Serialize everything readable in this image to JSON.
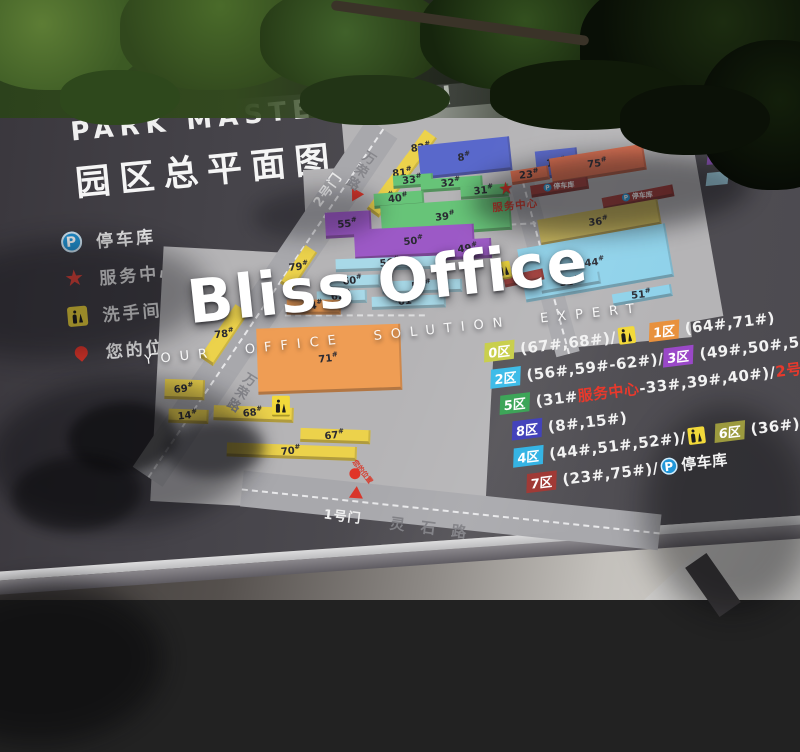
{
  "title": {
    "en": "PARK MASTER PLAN",
    "zh": "园区总平面图"
  },
  "watermark": {
    "brand": "Bliss Office",
    "tagline": "YOUR OFFICE SOLUTION EXPERT"
  },
  "map_legend": {
    "items": [
      {
        "icon": "parking-icon",
        "label": "停车库"
      },
      {
        "icon": "service-center-icon",
        "label": "服务中心"
      },
      {
        "icon": "restroom-icon",
        "label": "洗手间"
      },
      {
        "icon": "your-location-icon",
        "label": "您的位置"
      }
    ]
  },
  "zone_legend": {
    "rows": [
      {
        "left_zone": "0区",
        "left_name": "缤纷尚街",
        "swatch": "#e8cf45",
        "right_zone": "5区",
        "right_name": "视听影视"
      },
      {
        "left_zone": "1区",
        "left_name": "VR电竞娱乐",
        "swatch": "#e89440",
        "right_zone": "6区",
        "right_name": "筑梦飞船"
      },
      {
        "left_zone": "2区",
        "left_name": "创意聚落",
        "swatch": "#a6d7e8",
        "right_zone": "7区",
        "right_name": "创客空间"
      },
      {
        "left_zone": "3区",
        "left_name": "影视教育",
        "swatch": "#9659c2",
        "right_zone": "8区",
        "right_name": "数字传媒"
      },
      {
        "left_zone": "4区",
        "left_name": "模型工坊",
        "swatch": "#a6d7e8",
        "right_zone": "",
        "right_name": ""
      }
    ]
  },
  "building_index": {
    "rows": [
      [
        {
          "sw": "0区",
          "c": "#c9cf4d"
        },
        {
          "t": "(67#,68#)/"
        },
        {
          "wc": true
        },
        {
          "gap": 14
        },
        {
          "sw": "1区",
          "c": "#e8913d"
        },
        {
          "t": "(64#,71#)"
        }
      ],
      [
        {
          "sw": "2区",
          "c": "#3fbce8"
        },
        {
          "t": "(56#,59#-62#)/"
        },
        {
          "sw": "3区",
          "c": "#9a48c8"
        },
        {
          "t": "(49#,50#,55#)"
        }
      ],
      [
        {
          "sw": "5区",
          "c": "#3da558"
        },
        {
          "t": "(31#"
        },
        {
          "t": "服务中心",
          "red": true
        },
        {
          "t": "-33#,39#,40#)/"
        },
        {
          "t": "2号门",
          "red": true
        }
      ],
      [
        {
          "sw": "8区",
          "c": "#4343bb"
        },
        {
          "t": "(8#,15#)"
        }
      ],
      [
        {
          "sw": "4区",
          "c": "#35b4e4"
        },
        {
          "t": "(44#,51#,52#)/"
        },
        {
          "wc": true
        },
        {
          "gap": 10
        },
        {
          "sw": "6区",
          "c": "#9c9a3e"
        },
        {
          "t": "(36#)"
        }
      ],
      [
        {
          "sw": "7区",
          "c": "#a03a36"
        },
        {
          "t": "(23#,75#)/"
        },
        {
          "p": true
        },
        {
          "t": "停车库"
        }
      ]
    ]
  },
  "map": {
    "roads": {
      "wanrong": "万荣路",
      "lingshi": "灵石路"
    },
    "gates": {
      "gate2": "2号门",
      "gate1": "1号门"
    },
    "service_center": "服务中心",
    "parking_label": "停车库",
    "your_location": "您的位置",
    "colors": {
      "y": "#ecd24b",
      "o": "#ef9d54",
      "b": "#5968cb",
      "g": "#67c478",
      "p": "#9c59c6",
      "c": "#a8d9e8",
      "c2": "#8fd2ea",
      "ol": "#c4b257",
      "r": "#e2704f",
      "dr": "#a33e3a"
    },
    "buildings": [
      {
        "l": "82",
        "c": "y",
        "x": 295,
        "y": 27,
        "w": 15,
        "h": 36,
        "r": 42
      },
      {
        "l": "81",
        "c": "y",
        "x": 274,
        "y": 50,
        "w": 15,
        "h": 36,
        "r": 42
      },
      {
        "l": "80",
        "c": "y",
        "x": 253,
        "y": 73,
        "w": 15,
        "h": 36,
        "r": 42
      },
      {
        "l": "79",
        "c": "y",
        "x": 162,
        "y": 128,
        "w": 14,
        "h": 46,
        "r": 40
      },
      {
        "l": "78",
        "c": "y",
        "x": 80,
        "y": 178,
        "w": 16,
        "h": 64,
        "r": 40
      },
      {
        "l": "8",
        "c": "b",
        "x": 300,
        "y": 42,
        "w": 92,
        "h": 34,
        "r": 0
      },
      {
        "l": "15",
        "c": "b",
        "x": 416,
        "y": 60,
        "w": 42,
        "h": 28,
        "r": 0
      },
      {
        "l": "33",
        "c": "g",
        "x": 272,
        "y": 70,
        "w": 40,
        "h": 13,
        "r": 2
      },
      {
        "l": "32",
        "c": "g",
        "x": 299,
        "y": 77,
        "w": 62,
        "h": 13,
        "r": 2
      },
      {
        "l": "31",
        "c": "g",
        "x": 338,
        "y": 88,
        "w": 48,
        "h": 13,
        "r": 2
      },
      {
        "l": "40",
        "c": "g",
        "x": 251,
        "y": 86,
        "w": 50,
        "h": 15,
        "r": 2
      },
      {
        "l": "39",
        "c": "g",
        "x": 256,
        "y": 100,
        "w": 130,
        "h": 33,
        "r": 2
      },
      {
        "l": "55",
        "c": "p",
        "x": 200,
        "y": 100,
        "w": 46,
        "h": 26,
        "r": 3
      },
      {
        "l": "50",
        "c": "p",
        "x": 227,
        "y": 122,
        "w": 120,
        "h": 30,
        "r": 3
      },
      {
        "l": "49",
        "c": "p",
        "x": 317,
        "y": 140,
        "w": 46,
        "h": 20,
        "r": 3
      },
      {
        "l": "56",
        "c": "c",
        "x": 206,
        "y": 150,
        "w": 110,
        "h": 13,
        "r": 4
      },
      {
        "l": "60",
        "c": "c",
        "x": 195,
        "y": 164,
        "w": 54,
        "h": 13,
        "r": 4
      },
      {
        "l": "62",
        "c": "c",
        "x": 184,
        "y": 178,
        "w": 50,
        "h": 13,
        "r": 4
      },
      {
        "l": "59",
        "c": "c",
        "x": 250,
        "y": 176,
        "w": 80,
        "h": 13,
        "r": 4
      },
      {
        "l": "61",
        "c": "c",
        "x": 238,
        "y": 190,
        "w": 74,
        "h": 13,
        "r": 4
      },
      {
        "l": "64",
        "c": "o",
        "x": 153,
        "y": 184,
        "w": 54,
        "h": 15,
        "r": 6
      },
      {
        "l": "71",
        "c": "o",
        "x": 118,
        "y": 212,
        "w": 144,
        "h": 66,
        "r": 4
      },
      {
        "l": "69",
        "c": "y",
        "x": 23,
        "y": 250,
        "w": 40,
        "h": 20,
        "r": 8
      },
      {
        "l": "14",
        "c": "y",
        "x": 24,
        "y": 280,
        "w": 40,
        "h": 14,
        "r": 8
      },
      {
        "l": "68",
        "c": "y",
        "x": 69,
        "y": 284,
        "w": 80,
        "h": 15,
        "r": 8
      },
      {
        "l": "67",
        "c": "y",
        "x": 153,
        "y": 315,
        "w": 70,
        "h": 14,
        "r": 8
      },
      {
        "l": "70",
        "c": "y",
        "x": 78,
        "y": 326,
        "w": 130,
        "h": 14,
        "r": 8
      },
      {
        "l": "75",
        "c": "r",
        "x": 430,
        "y": 66,
        "w": 95,
        "h": 26,
        "r": -3
      },
      {
        "l": "23",
        "c": "r",
        "x": 390,
        "y": 76,
        "w": 38,
        "h": 14,
        "r": -3
      },
      {
        "type": "parking",
        "c": "dr",
        "x": 408,
        "y": 92,
        "w": 58,
        "h": 12,
        "r": -3
      },
      {
        "type": "parking",
        "c": "dr",
        "x": 478,
        "y": 110,
        "w": 72,
        "h": 12,
        "r": -5
      },
      {
        "l": "36",
        "c": "ol",
        "x": 412,
        "y": 124,
        "w": 122,
        "h": 26,
        "r": -4
      },
      {
        "l": "44",
        "c": "c2",
        "x": 390,
        "y": 150,
        "w": 150,
        "h": 54,
        "r": -4
      },
      {
        "l": "52",
        "c": "c2",
        "x": 408,
        "y": 188,
        "w": 60,
        "h": 12,
        "r": -4
      },
      {
        "l": "51",
        "c": "c2",
        "x": 478,
        "y": 208,
        "w": 60,
        "h": 12,
        "r": -4
      },
      {
        "c": "dr",
        "x": 372,
        "y": 179,
        "w": 40,
        "h": 11,
        "r": -6
      }
    ]
  }
}
